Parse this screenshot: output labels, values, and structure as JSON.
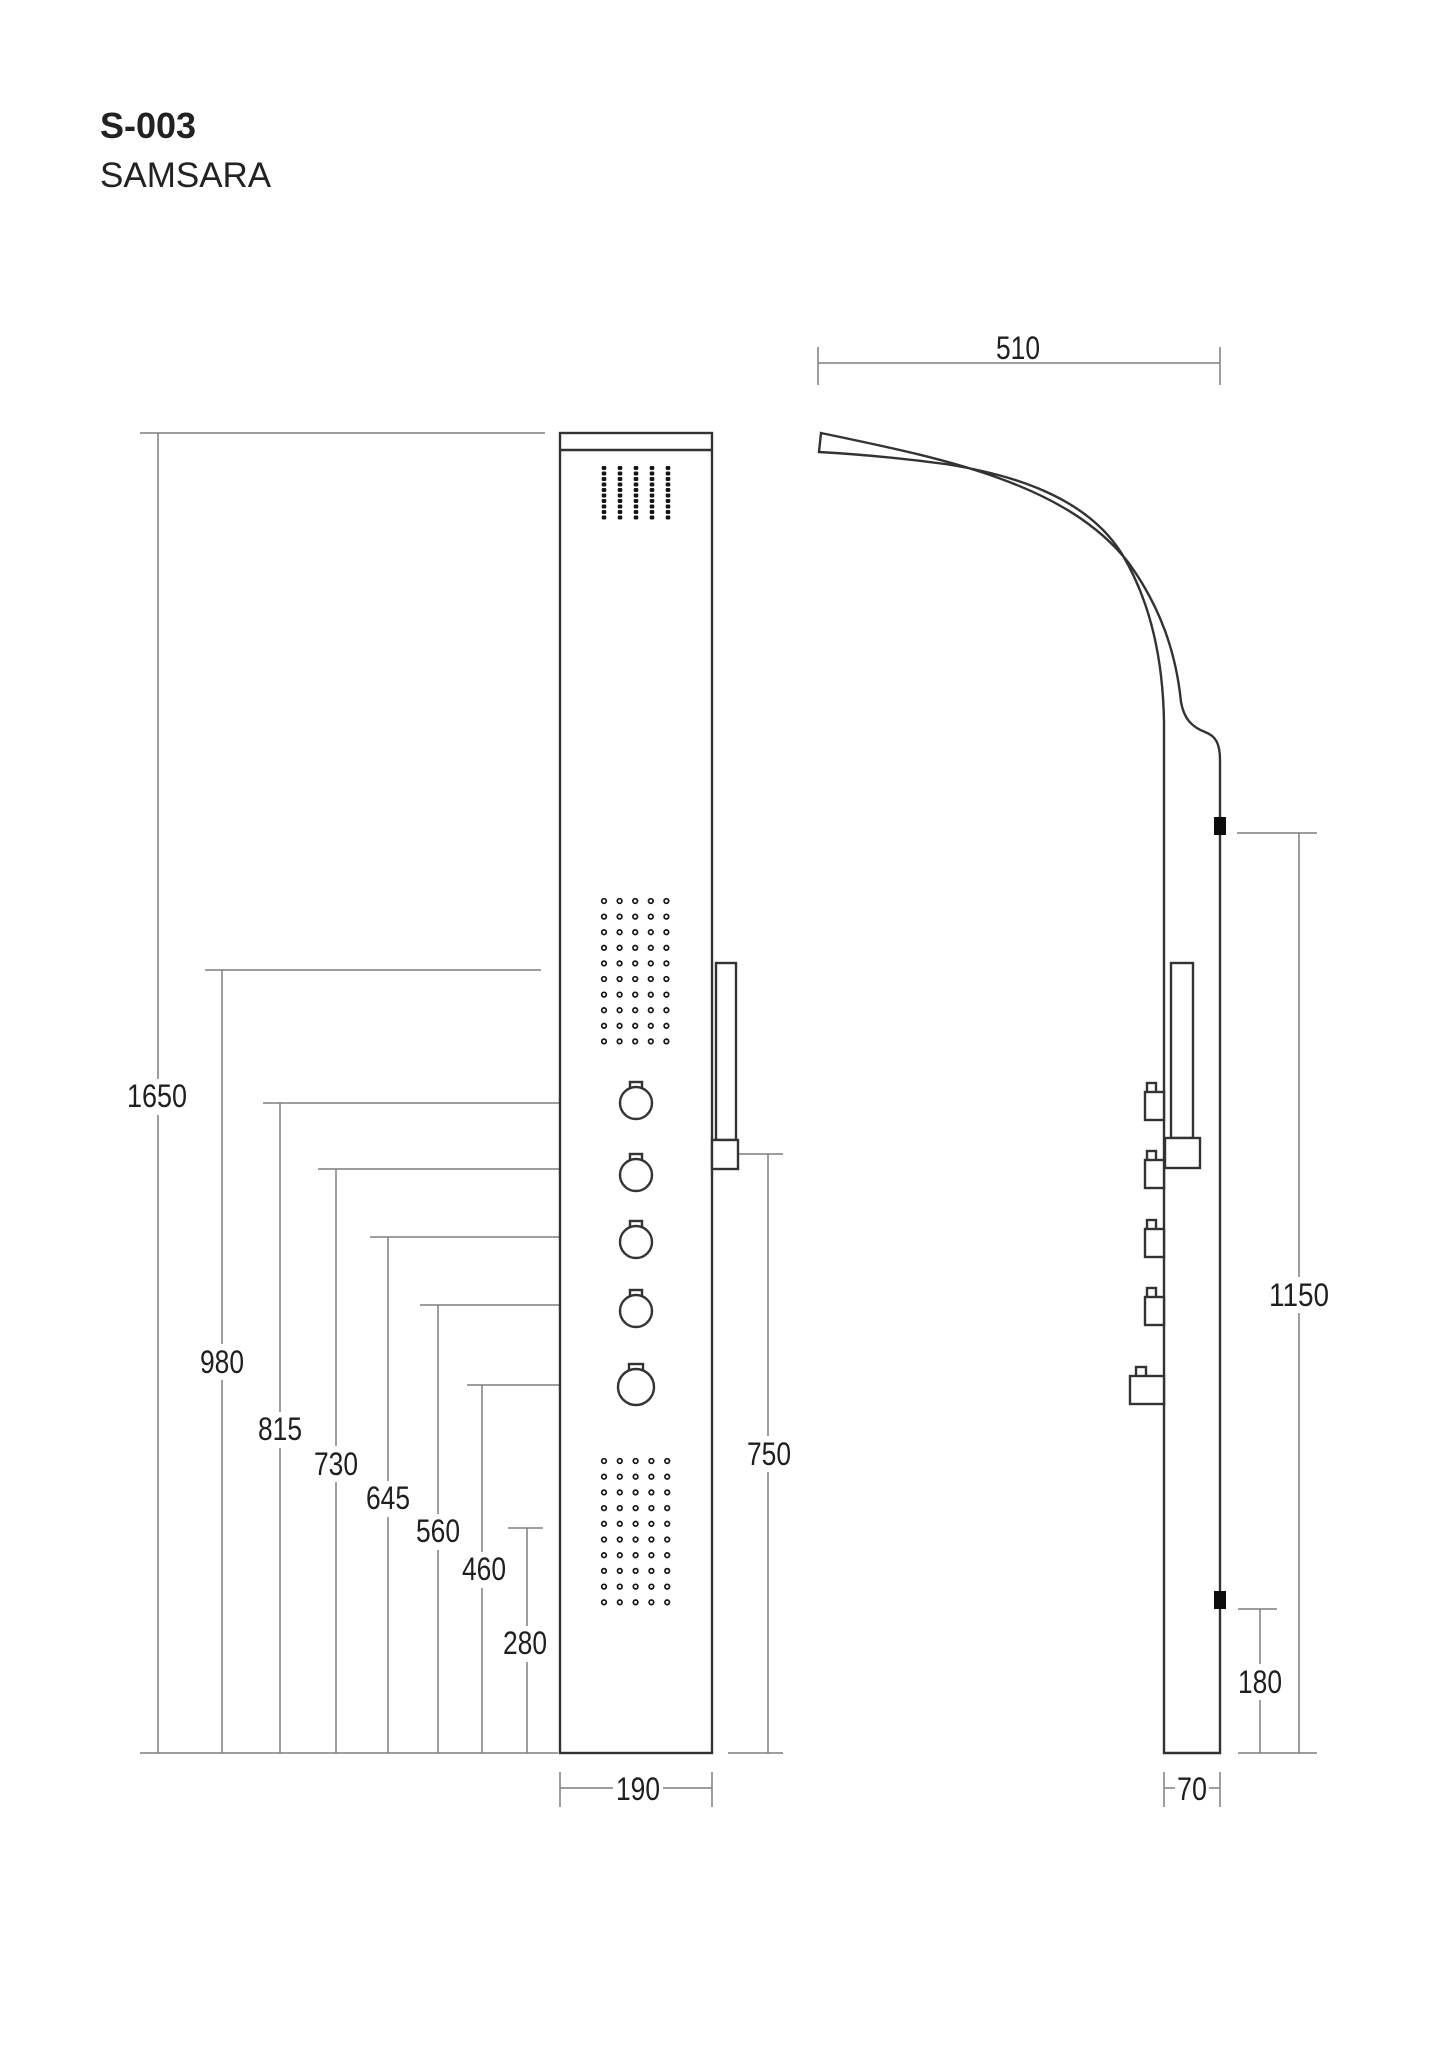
{
  "title": {
    "model": "S-003",
    "name": "SAMSARA"
  },
  "dimensions": {
    "total_height": "1650",
    "upper_body_jets_height": "980",
    "knob_heights": [
      "815",
      "730",
      "645",
      "560",
      "460"
    ],
    "lower_body_jets_height": "280",
    "hand_shower_holder_height": "750",
    "panel_width": "190",
    "head_arm_reach": "510",
    "wall_mount_span": "1150",
    "lower_mount_height": "180",
    "panel_depth": "70"
  },
  "front_view": {
    "grids": [
      {
        "id": "head-spray-grid",
        "type": "dash",
        "cols": 5,
        "rows": 10,
        "x0": 604,
        "y0": 468,
        "dx": 16,
        "dy": 5.5,
        "w": 4.6,
        "h": 4
      },
      {
        "id": "upper-body-jets",
        "type": "ring",
        "cols": 5,
        "rows": 10,
        "x0": 604,
        "y0": 901,
        "dx": 15.6,
        "dy": 15.6,
        "r": 2.3
      },
      {
        "id": "lower-body-jets",
        "type": "ring",
        "cols": 5,
        "rows": 10,
        "x0": 604,
        "y0": 1461,
        "dx": 15.8,
        "dy": 15.7,
        "r": 2.3
      }
    ]
  },
  "colors": {
    "outline": "#333333",
    "dimension_line": "#7f7f7f",
    "text": "#1f1f1f",
    "marker": "#0d0d0d",
    "background": "#ffffff"
  }
}
